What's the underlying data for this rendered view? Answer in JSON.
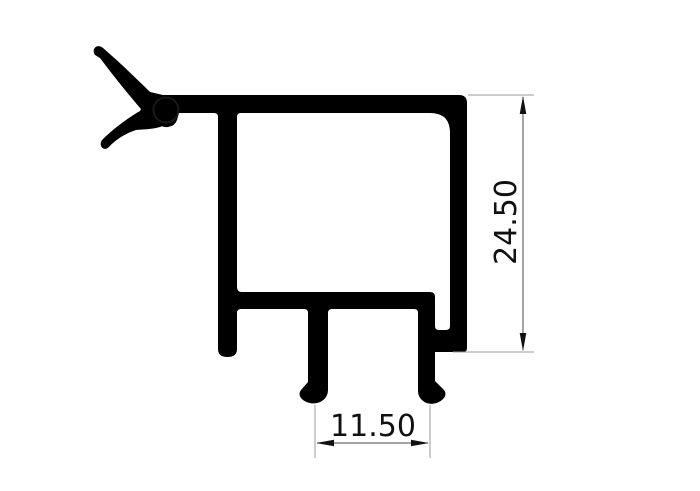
{
  "drawing": {
    "type": "technical-drawing",
    "subject": "aluminium-extrusion-profile-cross-section-with-gasket",
    "background_color": "#ffffff",
    "profile_color": "#000000",
    "gasket_color": "#000000",
    "extension_line_color": "#9b9b9b",
    "dimension_line_color": "#4a4a4a",
    "arrow_color": "#111111",
    "text_color": "#111111",
    "dimensions": {
      "vertical": {
        "label": "24.50",
        "value": 24.5
      },
      "horizontal": {
        "label": "11.50",
        "value": 11.5
      }
    }
  }
}
